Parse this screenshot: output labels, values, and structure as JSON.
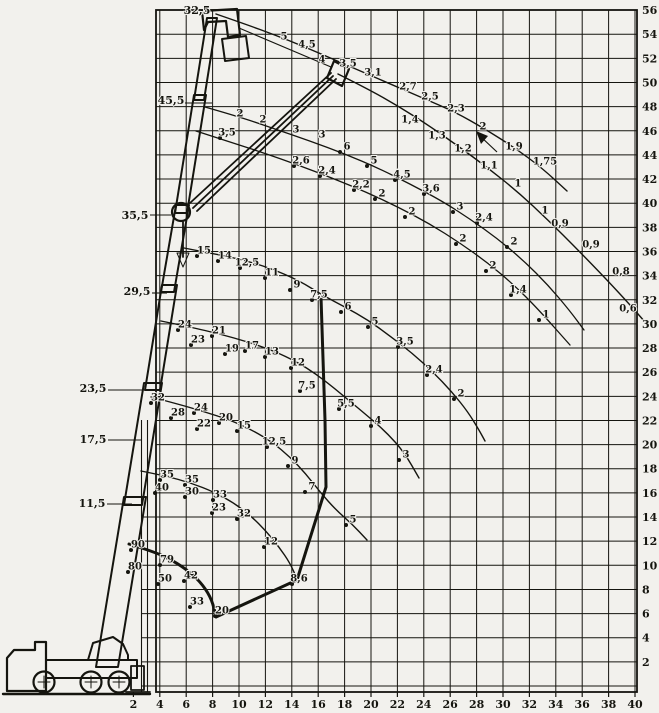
{
  "meta": {
    "bg": "#f2f1ed",
    "ink": "#15150f"
  },
  "axes": {
    "x_ticks": [
      2,
      4,
      6,
      8,
      10,
      12,
      14,
      16,
      18,
      20,
      22,
      24,
      26,
      28,
      30,
      32,
      34,
      36,
      38,
      40
    ],
    "y_ticks": [
      56,
      54,
      52,
      50,
      48,
      46,
      44,
      42,
      40,
      38,
      36,
      34,
      32,
      30,
      28,
      26,
      24,
      22,
      20,
      18,
      16,
      14,
      12,
      10,
      8,
      6,
      4,
      2
    ]
  },
  "boom_labels": [
    {
      "t": "32,5",
      "x": 197,
      "y": 10
    },
    {
      "t": "45,5",
      "x": 171,
      "y": 100
    },
    {
      "t": "35,5",
      "x": 135,
      "y": 215
    },
    {
      "t": "29,5",
      "x": 137,
      "y": 291
    },
    {
      "t": "23,5",
      "x": 93,
      "y": 388
    },
    {
      "t": "17,5",
      "x": 93,
      "y": 439
    },
    {
      "t": "11,5",
      "x": 92,
      "y": 503
    }
  ],
  "leader_lines": [
    [
      185,
      103,
      212,
      103
    ],
    [
      150,
      215,
      171,
      215
    ],
    [
      152,
      293,
      167,
      293
    ],
    [
      108,
      390,
      150,
      390
    ],
    [
      108,
      440,
      142,
      440
    ],
    [
      107,
      504,
      132,
      504
    ]
  ],
  "curves": [
    {
      "id": "jib-upper",
      "w": 1.4,
      "dots": false,
      "pts": [
        [
          216,
          14
        ],
        [
          245,
          24
        ],
        [
          275,
          35
        ],
        [
          305,
          47
        ],
        [
          335,
          60
        ],
        [
          365,
          73
        ],
        [
          395,
          86
        ],
        [
          425,
          99
        ],
        [
          455,
          112
        ],
        [
          485,
          129
        ],
        [
          515,
          148
        ],
        [
          542,
          168
        ],
        [
          567,
          191
        ]
      ],
      "labels": [
        {
          "t": "5",
          "x": 284,
          "y": 36
        },
        {
          "t": "4,5",
          "x": 307,
          "y": 44
        },
        {
          "t": "4",
          "x": 322,
          "y": 59
        },
        {
          "t": "3,5",
          "x": 348,
          "y": 63
        },
        {
          "t": "3,1",
          "x": 373,
          "y": 72
        },
        {
          "t": "2,7",
          "x": 408,
          "y": 86
        },
        {
          "t": "2,5",
          "x": 430,
          "y": 96
        },
        {
          "t": "2,3",
          "x": 456,
          "y": 108
        },
        {
          "t": "2",
          "x": 483,
          "y": 126
        },
        {
          "t": "1,9",
          "x": 514,
          "y": 146
        },
        {
          "t": "1,75",
          "x": 545,
          "y": 161
        }
      ]
    },
    {
      "id": "jib-lower",
      "w": 1.4,
      "dots": false,
      "pts": [
        [
          338,
          74
        ],
        [
          368,
          89
        ],
        [
          398,
          106
        ],
        [
          428,
          125
        ],
        [
          458,
          146
        ],
        [
          488,
          168
        ],
        [
          518,
          192
        ],
        [
          548,
          220
        ],
        [
          578,
          250
        ],
        [
          608,
          281
        ],
        [
          631,
          306
        ],
        [
          645,
          322
        ]
      ],
      "labels": [
        {
          "t": "1,4",
          "x": 410,
          "y": 119
        },
        {
          "t": "1,3",
          "x": 437,
          "y": 135
        },
        {
          "t": "1,2",
          "x": 463,
          "y": 148
        },
        {
          "t": "1,1",
          "x": 489,
          "y": 165
        },
        {
          "t": "1",
          "x": 518,
          "y": 183
        },
        {
          "t": "1",
          "x": 545,
          "y": 210
        },
        {
          "t": "0,9",
          "x": 560,
          "y": 223
        },
        {
          "t": "0,9",
          "x": 591,
          "y": 244
        },
        {
          "t": "0,8",
          "x": 621,
          "y": 271
        },
        {
          "t": "0,6",
          "x": 628,
          "y": 308
        }
      ]
    },
    {
      "id": "boom-45-upper",
      "w": 1.3,
      "dots": true,
      "pts": [
        [
          205,
          107
        ],
        [
          240,
          117
        ],
        [
          275,
          129
        ],
        [
          310,
          141
        ],
        [
          345,
          154
        ],
        [
          378,
          168
        ],
        [
          410,
          184
        ],
        [
          442,
          201
        ],
        [
          470,
          219
        ],
        [
          498,
          239
        ],
        [
          524,
          261
        ],
        [
          548,
          285
        ],
        [
          570,
          311
        ],
        [
          584,
          330
        ]
      ],
      "labels": [
        {
          "t": "6",
          "x": 347,
          "y": 146
        },
        {
          "t": "5",
          "x": 374,
          "y": 160
        },
        {
          "t": "4,5",
          "x": 402,
          "y": 174
        },
        {
          "t": "3,6",
          "x": 431,
          "y": 188
        },
        {
          "t": "3",
          "x": 460,
          "y": 206
        },
        {
          "t": "2,4",
          "x": 484,
          "y": 217
        },
        {
          "t": "2",
          "x": 514,
          "y": 241
        }
      ]
    },
    {
      "id": "boom-45-lower",
      "w": 1.3,
      "dots": true,
      "pts": [
        [
          196,
          131
        ],
        [
          230,
          142
        ],
        [
          264,
          153
        ],
        [
          298,
          165
        ],
        [
          332,
          178
        ],
        [
          366,
          192
        ],
        [
          398,
          207
        ],
        [
          430,
          224
        ],
        [
          460,
          243
        ],
        [
          488,
          263
        ],
        [
          514,
          285
        ],
        [
          538,
          309
        ],
        [
          570,
          345
        ]
      ],
      "labels": [
        {
          "t": "3,5",
          "x": 227,
          "y": 132
        },
        {
          "t": "2,6",
          "x": 301,
          "y": 160
        },
        {
          "t": "2,4",
          "x": 327,
          "y": 170
        },
        {
          "t": "2,2",
          "x": 361,
          "y": 184
        },
        {
          "t": "2",
          "x": 382,
          "y": 193
        },
        {
          "t": "2",
          "x": 412,
          "y": 211
        },
        {
          "t": "2",
          "x": 463,
          "y": 238
        },
        {
          "t": "2",
          "x": 493,
          "y": 265
        },
        {
          "t": "1,4",
          "x": 518,
          "y": 289
        },
        {
          "t": "1",
          "x": 546,
          "y": 314
        }
      ]
    },
    {
      "id": "boom-35",
      "w": 1.4,
      "dots": true,
      "pts": [
        [
          184,
          248
        ],
        [
          210,
          253
        ],
        [
          240,
          259
        ],
        [
          270,
          268
        ],
        [
          300,
          281
        ],
        [
          322,
          295
        ],
        [
          345,
          307
        ],
        [
          368,
          320
        ],
        [
          390,
          336
        ],
        [
          412,
          353
        ],
        [
          433,
          372
        ],
        [
          452,
          392
        ],
        [
          468,
          412
        ],
        [
          479,
          430
        ],
        [
          485,
          441
        ]
      ],
      "labels": [
        {
          "t": "15",
          "x": 204,
          "y": 250
        },
        {
          "t": "14",
          "x": 225,
          "y": 255
        },
        {
          "t": "12,5",
          "x": 247,
          "y": 262
        },
        {
          "t": "11",
          "x": 272,
          "y": 272
        },
        {
          "t": "9",
          "x": 297,
          "y": 284
        },
        {
          "t": "7,5",
          "x": 319,
          "y": 294
        },
        {
          "t": "6",
          "x": 348,
          "y": 306
        },
        {
          "t": "5",
          "x": 375,
          "y": 321
        },
        {
          "t": "3,5",
          "x": 405,
          "y": 341
        },
        {
          "t": "2,4",
          "x": 434,
          "y": 369
        },
        {
          "t": "2",
          "x": 461,
          "y": 393
        }
      ]
    },
    {
      "id": "boom-29",
      "w": 1.4,
      "dots": true,
      "pts": [
        [
          161,
          321
        ],
        [
          190,
          327
        ],
        [
          220,
          334
        ],
        [
          248,
          342
        ],
        [
          274,
          351
        ],
        [
          297,
          362
        ],
        [
          316,
          374
        ],
        [
          334,
          388
        ],
        [
          352,
          403
        ],
        [
          370,
          418
        ],
        [
          387,
          433
        ],
        [
          404,
          452
        ],
        [
          419,
          478
        ]
      ],
      "labels": [
        {
          "t": "24",
          "x": 185,
          "y": 324
        },
        {
          "t": "23",
          "x": 198,
          "y": 339
        },
        {
          "t": "21",
          "x": 219,
          "y": 330
        },
        {
          "t": "19",
          "x": 232,
          "y": 348
        },
        {
          "t": "17",
          "x": 252,
          "y": 345
        },
        {
          "t": "13",
          "x": 272,
          "y": 351
        },
        {
          "t": "12",
          "x": 298,
          "y": 362
        },
        {
          "t": "7,5",
          "x": 307,
          "y": 385
        },
        {
          "t": "5,5",
          "x": 346,
          "y": 403
        },
        {
          "t": "4",
          "x": 378,
          "y": 420
        },
        {
          "t": "3",
          "x": 406,
          "y": 454
        }
      ]
    },
    {
      "id": "boom-23",
      "w": 1.4,
      "dots": true,
      "pts": [
        [
          151,
          397
        ],
        [
          178,
          404
        ],
        [
          205,
          412
        ],
        [
          230,
          420
        ],
        [
          252,
          430
        ],
        [
          272,
          442
        ],
        [
          290,
          457
        ],
        [
          306,
          474
        ],
        [
          320,
          492
        ],
        [
          336,
          510
        ],
        [
          352,
          524
        ],
        [
          367,
          540
        ]
      ],
      "labels": [
        {
          "t": "32",
          "x": 158,
          "y": 397
        },
        {
          "t": "28",
          "x": 178,
          "y": 412
        },
        {
          "t": "24",
          "x": 201,
          "y": 407
        },
        {
          "t": "22",
          "x": 204,
          "y": 423
        },
        {
          "t": "20",
          "x": 226,
          "y": 417
        },
        {
          "t": "15",
          "x": 244,
          "y": 425
        },
        {
          "t": "12,5",
          "x": 274,
          "y": 441
        },
        {
          "t": "9",
          "x": 295,
          "y": 460
        },
        {
          "t": "7",
          "x": 312,
          "y": 486
        },
        {
          "t": "5",
          "x": 353,
          "y": 519
        }
      ]
    },
    {
      "id": "boom-17",
      "w": 1.4,
      "dots": true,
      "pts": [
        [
          141,
          471
        ],
        [
          166,
          476
        ],
        [
          191,
          483
        ],
        [
          214,
          492
        ],
        [
          234,
          503
        ],
        [
          251,
          516
        ],
        [
          266,
          531
        ],
        [
          279,
          547
        ],
        [
          290,
          563
        ],
        [
          297,
          579
        ]
      ],
      "labels": [
        {
          "t": "35",
          "x": 167,
          "y": 474
        },
        {
          "t": "40",
          "x": 162,
          "y": 487
        },
        {
          "t": "35",
          "x": 192,
          "y": 479
        },
        {
          "t": "30",
          "x": 192,
          "y": 491
        },
        {
          "t": "33",
          "x": 220,
          "y": 494
        },
        {
          "t": "23",
          "x": 219,
          "y": 507
        },
        {
          "t": "32",
          "x": 244,
          "y": 513
        },
        {
          "t": "12",
          "x": 271,
          "y": 541
        },
        {
          "t": "8,6",
          "x": 299,
          "y": 578
        }
      ]
    },
    {
      "id": "boom-11",
      "w": 3,
      "dots": true,
      "pts": [
        [
          129,
          544
        ],
        [
          152,
          551
        ],
        [
          172,
          560
        ],
        [
          190,
          572
        ],
        [
          203,
          585
        ],
        [
          212,
          600
        ],
        [
          216,
          617
        ]
      ],
      "labels": [
        {
          "t": "90",
          "x": 138,
          "y": 544
        },
        {
          "t": "80",
          "x": 135,
          "y": 566
        },
        {
          "t": "79",
          "x": 167,
          "y": 559
        },
        {
          "t": "50",
          "x": 165,
          "y": 578
        },
        {
          "t": "42",
          "x": 191,
          "y": 575
        },
        {
          "t": "33",
          "x": 197,
          "y": 601
        },
        {
          "t": "20",
          "x": 222,
          "y": 610
        }
      ]
    }
  ],
  "boundary": {
    "w": 3,
    "pts": [
      [
        321,
        297
      ],
      [
        325,
        420
      ],
      [
        326,
        487
      ],
      [
        297,
        580
      ],
      [
        216,
        617
      ]
    ]
  },
  "extra": {
    "verticals": [
      [
        141.5,
        420,
        692
      ],
      [
        147.5,
        420,
        692
      ]
    ],
    "misc_labels": [
      {
        "t": "2",
        "x": 240,
        "y": 113
      },
      {
        "t": "2",
        "x": 263,
        "y": 119
      },
      {
        "t": "3",
        "x": 296,
        "y": 129
      },
      {
        "t": "3",
        "x": 322,
        "y": 134
      }
    ],
    "arrow_leader": {
      "x1": 497,
      "y1": 152,
      "x2": 480,
      "y2": 136
    }
  },
  "chart_data": {
    "type": "line",
    "x_range": [
      2,
      40
    ],
    "y_range": [
      2,
      56
    ],
    "grid": true,
    "description": "Mobile crane lifting-capacity chart: hook height vs working radius; one curve per boom length (11,5 - 45,5 m) plus jib 32,5; numbers along curves are capacities in tonnes",
    "boom_length_labels": [
      "32,5",
      "45,5",
      "35,5",
      "29,5",
      "23,5",
      "17,5",
      "11,5"
    ],
    "series": [
      {
        "name": "jib curve upper",
        "capacities": [
          5,
          4.5,
          4,
          3.5,
          3.1,
          2.7,
          2.5,
          2.3,
          2,
          1.9,
          1.75
        ]
      },
      {
        "name": "jib curve lower",
        "capacities": [
          1.4,
          1.3,
          1.2,
          1.1,
          1,
          1,
          0.9,
          0.9,
          0.8,
          0.6
        ]
      },
      {
        "name": "boom 45,5 upper",
        "capacities": [
          6,
          5,
          4.5,
          3.6,
          3,
          2.4,
          2
        ]
      },
      {
        "name": "boom 45,5 lower",
        "capacities": [
          3.5,
          2.6,
          2.4,
          2.2,
          2,
          2,
          2,
          2,
          1.4,
          1
        ]
      },
      {
        "name": "boom 35,5",
        "capacities": [
          15,
          14,
          12.5,
          11,
          9,
          7.5,
          6,
          5,
          3.5,
          2.4,
          2
        ]
      },
      {
        "name": "boom 29,5",
        "capacities": [
          24,
          23,
          21,
          19,
          17,
          13,
          12,
          7.5,
          5.5,
          4,
          3
        ]
      },
      {
        "name": "boom 23,5",
        "capacities": [
          32,
          28,
          24,
          22,
          20,
          15,
          12.5,
          9,
          7,
          5
        ]
      },
      {
        "name": "boom 17,5",
        "capacities": [
          35,
          40,
          35,
          30,
          33,
          23,
          32,
          12,
          8.6
        ]
      },
      {
        "name": "boom 11,5",
        "capacities": [
          90,
          80,
          79,
          50,
          42,
          33,
          20
        ]
      }
    ]
  }
}
